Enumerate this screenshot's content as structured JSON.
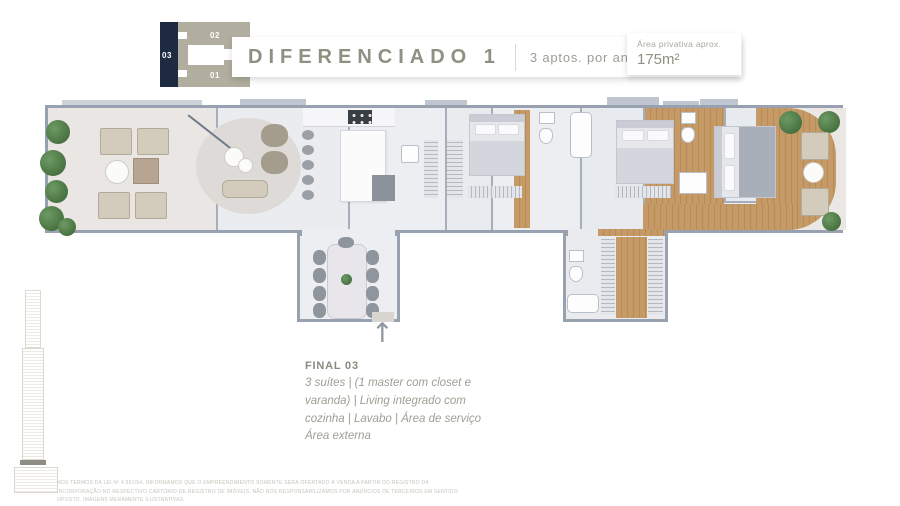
{
  "keyplan": {
    "unit_top": "02",
    "unit_left": "03",
    "unit_bottom": "01"
  },
  "header": {
    "title": "DIFERENCIADO 1",
    "apartments_per_floor": "3 aptos. por andar",
    "area_label": "Área privativa aprox.",
    "area_value": "175m²"
  },
  "unit_info": {
    "heading": "FINAL 03",
    "description": "3 suítes  |  (1 master com closet e varanda)  |  Living integrado com cozinha  |  Lavabo  |  Área de serviço  Área externa"
  },
  "disclaimer": "NOS TERMOS DA LEI Nº 4.591/64, INFORMAMOS QUE O EMPREENDIMENTO SOMENTE SERÁ OFERTADO À VENDA A PARTIR DO REGISTRO DA INCORPORAÇÃO NO RESPECTIVO CARTÓRIO DE REGISTRO DE IMÓVEIS. NÃO NOS RESPONSABILIZAMOS POR ANÚNCIOS DE TERCEIROS EM SENTIDO OPOSTO. IMAGENS MERAMENTE ILUSTRATIVAS.",
  "icons": {
    "north_arrow": "↑"
  },
  "colors": {
    "accent_olive": "#8f9081",
    "keyplan_navy": "#1e2a3f",
    "keyplan_beige": "#b1ae9f",
    "wood_floor": "#c59a66",
    "wall": "#97a1af",
    "plant_green": "#55804f"
  }
}
